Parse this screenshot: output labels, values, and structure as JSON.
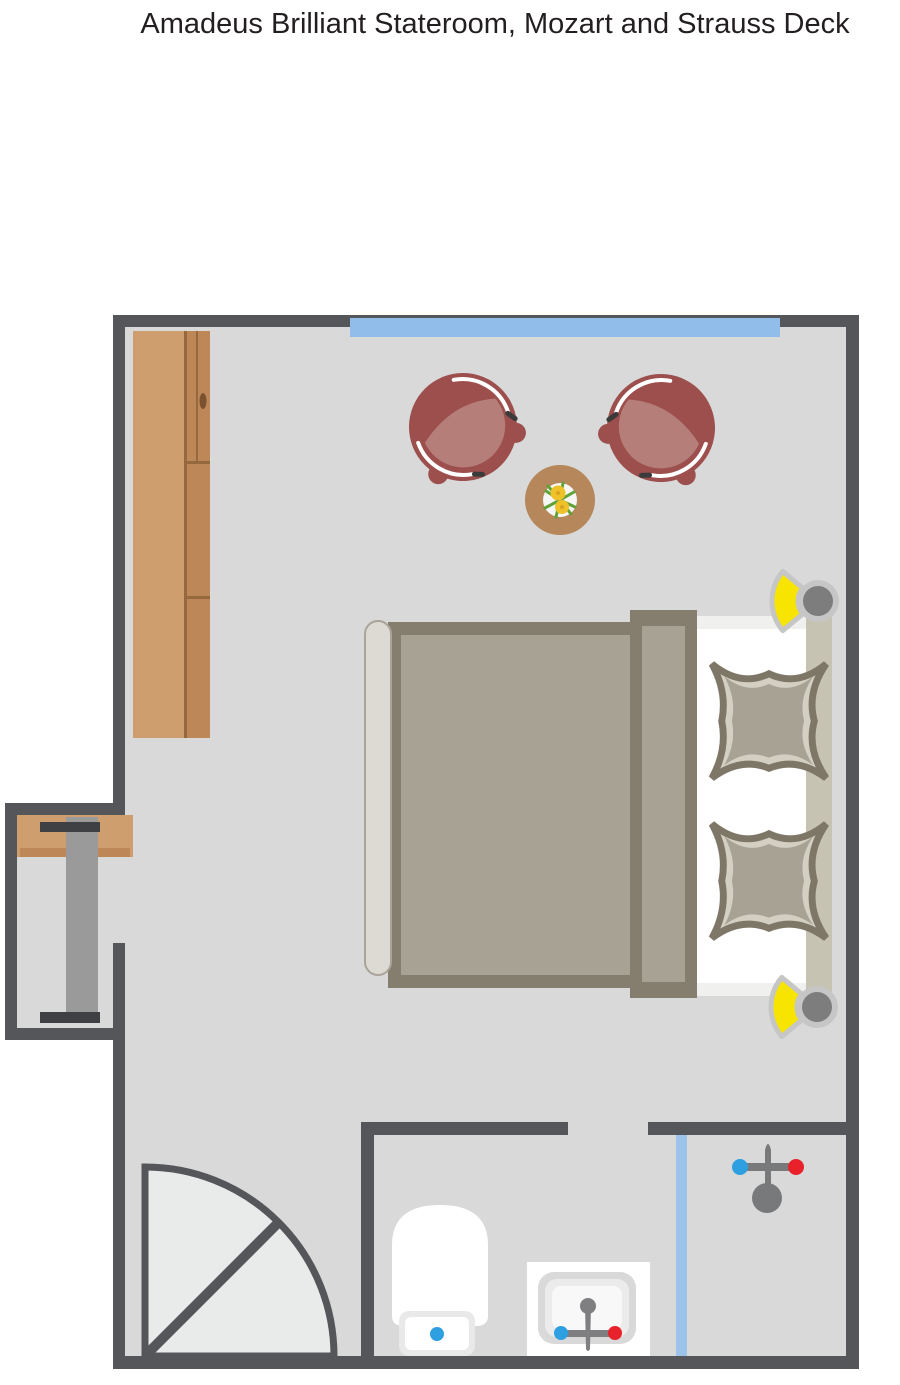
{
  "title": "Amadeus Brilliant Stateroom, Mozart and Strauss Deck",
  "colors": {
    "title_text": "#231f20",
    "wall": "#55565a",
    "floor": "#d8d9d8",
    "door_swing": "#e9ebeb",
    "window_glass": "#90bde9",
    "shower_glass": "#9cc4eb",
    "wood": "#cf9e6f",
    "wood_mid": "#bd8758",
    "wood_dark": "#96683d",
    "handle_dark": "#7a5230",
    "chair_shell": "#9c4f4d",
    "chair_seat": "#b57e79",
    "table_wood": "#b5875b",
    "plate_white": "#f6f6f4",
    "plant_green": "#61a238",
    "flower_yellow": "#f0c229",
    "flower_core": "#d9a31f",
    "bed_duvet": "#a8a295",
    "bed_border": "#857d6d",
    "bed_frame_light": "#dcdad2",
    "headboard": "#c7c3b3",
    "pillow_light": "#d3cfc2",
    "pillow_mid": "#a8a294",
    "pillow_edge": "#7e7666",
    "mattress": "#ffffff",
    "mattress_band": "#f0f0ee",
    "lamp_yellow": "#f7e400",
    "lamp_ring": "#c6c6c6",
    "lamp_gray": "#7d7d7d",
    "fixture_gray": "#7f7f82",
    "shower_fixture": "#77797b",
    "cold_water": "#2e9fe0",
    "hot_water": "#e8212a",
    "porcelain": "#ffffff",
    "tank_ring": "#e9e9e9",
    "basin_outer": "#d9d9d9",
    "basin_mid": "#ebebeb",
    "basin_inner": "#f8f8f8",
    "desk_chair_gray": "#9a9a9a",
    "dark_bar": "#3f4043"
  },
  "rooms": {
    "bedroom": "stateroom cabin with panoramic window, seating area, wardrobe, desk niche and double bed",
    "bathroom": "en-suite with toilet, washbasin and shower"
  },
  "furniture": {
    "window": "panoramic-window",
    "wardrobe": "wardrobe",
    "armchair_left": "tub-armchair",
    "armchair_right": "tub-armchair",
    "side_table": "round-side-table",
    "flowers": "flower-arrangement",
    "bed": "double-bed",
    "pillow_top": "pillow",
    "pillow_bottom": "pillow",
    "lamp_top": "reading-lamp",
    "lamp_bottom": "reading-lamp",
    "desk": "desk-with-chair",
    "entry_door": "entrance-door",
    "toilet": "toilet",
    "washbasin": "washbasin",
    "shower": "shower",
    "shower_screen": "glass-shower-screen"
  }
}
